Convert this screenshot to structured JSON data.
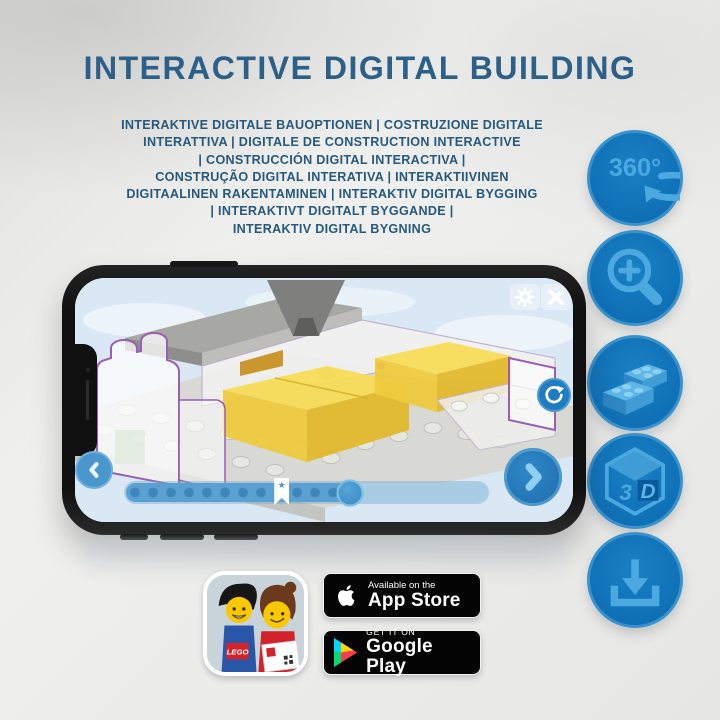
{
  "header": {
    "title": "INTERACTIVE DIGITAL BUILDING",
    "subtitle_lines": [
      "INTERAKTIVE DIGITALE BAUOPTIONEN | COSTRUZIONE DIGITALE",
      "INTERATTIVA | DIGITALE DE CONSTRUCTION INTERACTIVE",
      "| CONSTRUCCIÓN DIGITAL INTERACTIVA |",
      "CONSTRUÇÃO DIGITAL INTERATIVA | INTERAKTIIVINEN",
      "DIGITAALINEN RAKENTAMINEN | INTERAKTIV DIGITAL BYGGING",
      "| INTERAKTIVT DIGITALT BYGGANDE |",
      "INTERAKTIV DIGITAL BYGNING"
    ]
  },
  "feature_icons": {
    "rotation_label": "360°",
    "cube_left": "3",
    "cube_right": "D"
  },
  "phone_app": {
    "progress_percent": 62,
    "bookmark_percent": 43,
    "bookmark_glyph": "★"
  },
  "badges": {
    "lego_logo": "LEGO",
    "app_store": {
      "tagline": "Available on the",
      "store": "App Store"
    },
    "google_play": {
      "tagline": "GET IT ON",
      "store": "Google Play"
    }
  },
  "colors": {
    "title_blue": "#2d6088",
    "icon_circle_blue": "#0f70b6",
    "icon_glyph_blue": "#4ba9e0",
    "app_ui_blue": "#2e86c6",
    "lego_yellow": "#f2cf43",
    "badge_black": "#040404"
  }
}
